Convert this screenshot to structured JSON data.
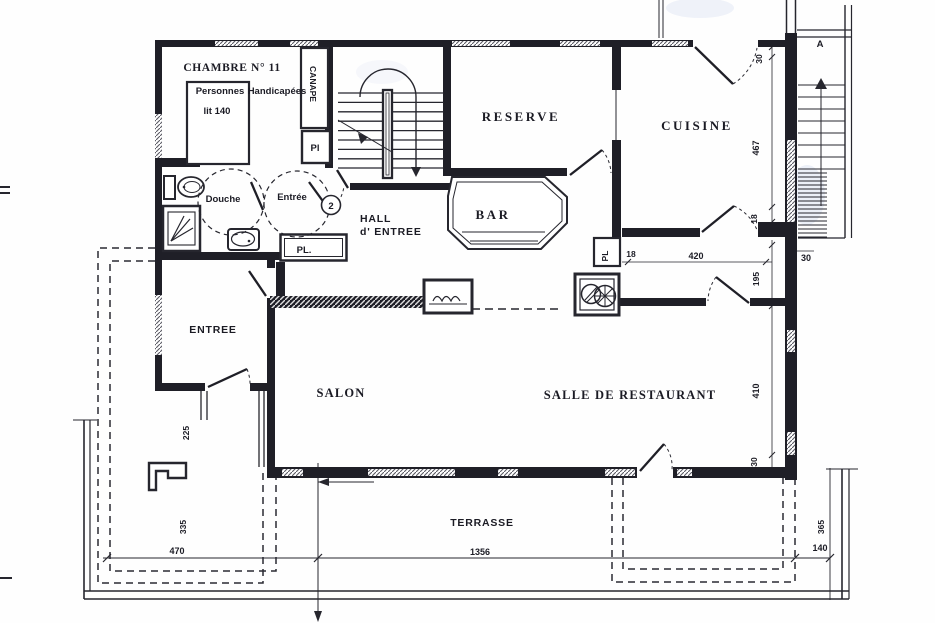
{
  "colors": {
    "ink": "#1f1f27",
    "paper": "#fefefe",
    "scan_smudge": "#aebfe4"
  },
  "rooms": {
    "chambre": "CHAMBRE  N° 11",
    "bed1": "Personnes",
    "bed2": "Handicapées",
    "bed3": "lit 140",
    "canape": "CANAPE",
    "pl_chambre": "Pl",
    "douche": "Douche",
    "entree_chambre": "Entrée",
    "door_badge": "2",
    "hall1": "HALL",
    "hall2": "d' ENTREE",
    "pl_hall": "PL.",
    "reserve": "RESERVE",
    "bar": "BAR",
    "cuisine": "CUISINE",
    "pl_cuisine": "PL",
    "entree": "ENTREE",
    "salon": "SALON",
    "restaurant": "SALLE DE RESTAURANT",
    "terrasse": "TERRASSE",
    "stair_label": "A"
  },
  "dims": {
    "d30_top": "30",
    "d467": "467",
    "d18_right": "18",
    "d18_pl": "18",
    "d420": "420",
    "d30_wall": "30",
    "d195": "195",
    "d410": "410",
    "d30_low": "30",
    "d225": "225",
    "d335": "335",
    "d470": "470",
    "d1356": "1356",
    "d365": "365",
    "d140": "140"
  }
}
